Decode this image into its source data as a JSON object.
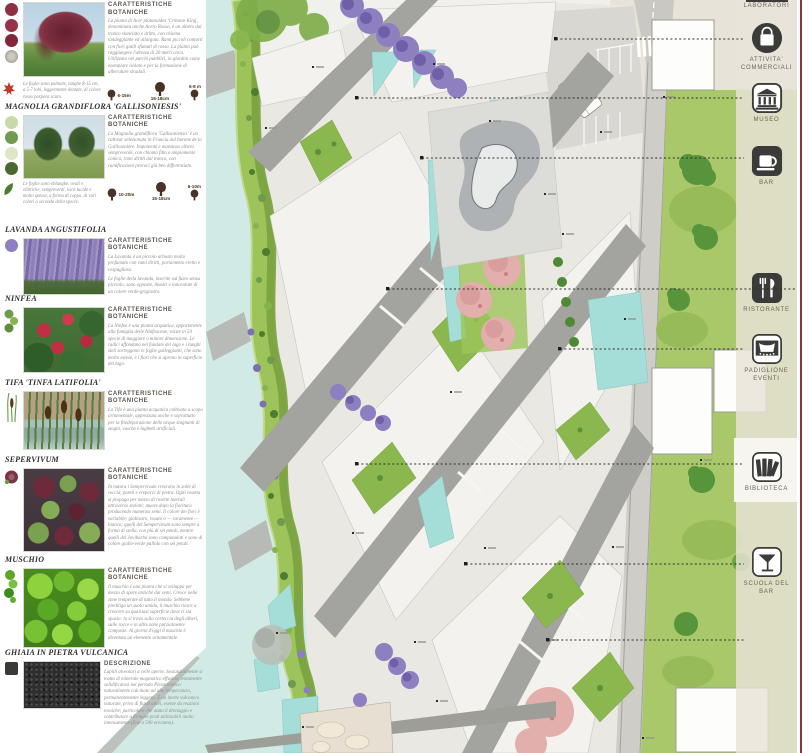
{
  "palette": {
    "river": "#d2eae6",
    "pool": "#a5ded9",
    "lawn": "#a9c869",
    "bank_green": "#9cc45a",
    "plaza": "#e9e8e3",
    "path_gray": "#a3a39f",
    "pink_trees": "#e2afac",
    "lavender": "#8d7fc0",
    "strip_beige": "#e9e4da",
    "border_red": "#8e3438",
    "icon_dark": "#3b3b39"
  },
  "left_panel": {
    "sections": [
      {
        "id": "acer",
        "heading": "CARATTERISTICHE BOTANICHE",
        "body": "La pianta di Acer platanoides 'Crimson King', denominata anche Acero Rosso, è un albero dal tronco slanciato e dritto, con chioma tondeggiante ed allargata. Rami piccoli contorti con fiori gialli sfumati di rosso. La pianta può raggiungere l'altezza di 20 metri circa. Utilizzato nei parchi pubblici, in giardini come esemplare isolato e per la formazione di alberature stradali.",
        "caption": "Le foglie sono palmate, lunghe 8-15 cm, a 5-7 lobi, leggermente dentate, di colore rosso porpora scuro.",
        "sizes": [
          "6-15m",
          "15-18cm",
          "6-8 m"
        ]
      },
      {
        "id": "magnolia",
        "title": "MAGNOLIA GRANDIFLORA 'GALLISONIESIS'",
        "heading": "CARATTERISTICHE BOTANICHE",
        "body": "La Magnolia grandiflora 'Gallisoniensis' è un cultivar selezionata in Francia dal barone de la Gallissonière. Imponente e maestoso albero sempreverde, con chioma fitta e ampiamente conica, rami diritti dal tronco, con ramificazioni precoci già ben differenziate.",
        "caption": "Le foglie sono oblunghe, ovali e ellittiche, sempreverdi, lisce lucide e molto spesse, a forma di coppa, di vari colori a seconda della specie.",
        "sizes": [
          "10-20m",
          "15-18cm",
          "6-10m"
        ]
      },
      {
        "id": "lavanda",
        "title": "LAVANDA ANGUSTIFOLIA",
        "heading": "CARATTERISTICHE BOTANICHE",
        "body": "La Lavanda è un piccolo arbusto molto profumato con rami diritti, portamento eretto e cespuglioso.",
        "body2": "Le foglie della lavanda, inserite sul fusto senza picciolo, sono opposte, lineari e lanceolate di un colore verde-grigiastro."
      },
      {
        "id": "ninfea",
        "title": "NINFEA",
        "heading": "CARATTERISTICHE BOTANICHE",
        "body": "La Ninfea è una pianta acquatica, appartenente alla famiglia delle Ninfeaceae; esiste in 50 specie di maggiore o minore dimensione. Le radici affondano nel fondale del lago e i lunghi steli sorreggono le foglie galleggianti, che sono molto estese, e i fiori che si aprono in superficie del lago."
      },
      {
        "id": "tifa",
        "title": "TIFA 'TINFA LATIFOLIA'",
        "heading": "CARATTERISTICHE BOTANICHE",
        "body": "La Tifa è una pianta acquatica coltivata a scopo ornamentale, apprezzata anche e soprattutto per la fitodepurazione delle acque stagnanti di stagni, vasche e laghetti artificiali."
      },
      {
        "id": "sempervivum",
        "title": "SEPERVIVUM",
        "heading": "CARATTERISTICHE BOTANICHE",
        "body": "In natura i Sempervivum crescono in zolle di roccia, pareti e crepacci di pietra. Ogni rosetta si propaga per mezzo di rosette laterali attraverso stoloni; muore dopo la fioritura producendo numerosi semi. Il colore dei fiori è variabile: giallastro, rosato o — raramente — bianco; quelli del Sempervivum sono sempre a forma di stella, con più di sei petali, mentre quelli del Jovibarba sono campanulati e sono di colore giallo-verde pallido con sei petali."
      },
      {
        "id": "muschio",
        "title": "MUSCHIO",
        "heading": "CARATTERISTICHE BOTANICHE",
        "body": "Il muschio è una pianta che si sviluppa per mezzo di spore anziché dai semi. Cresce nelle zone temperate di tutto il mondo. Sebbene prediliga un suolo umido, il muschio riesce a crescere su qualsiasi superficie dove ci sia spazio: lo si trova sulla corteccia degli alberi, sulle rocce e in altre zone parzialmente composte. Al giorno d'oggi il muschio è diventato un elemento ornamentale."
      },
      {
        "id": "ghiaia",
        "title": "GHIAIA IN PIETRA VULCANICA",
        "heading": "DESCRIZIONE",
        "body": "Lapilli alveolari a celle aperte. Sostanzialmente si tratta di minerale magmatico effusivo, lentamente solidificatosi nel periodo Pleistocenico: naturalmente calcinato ad alta temperatura, permanentemente leggero. È un inerte vulcanico naturale, privo di flussi attivi, esente da reazioni tossiche; particolare che aiuta il drenaggio e contribuisce a formare prati utilizzabili molto intensamente (fino a 500 ore/anno)."
      }
    ]
  },
  "facility_strip": {
    "top_cut_label": "LABORATORI",
    "items": [
      {
        "label": "ATTIVITA' COMMERCIALI",
        "icon": "shopping-bag"
      },
      {
        "label": "MUSEO",
        "icon": "museum"
      },
      {
        "label": "BAR",
        "icon": "coffee-cup"
      },
      {
        "label": "RISTORANTE",
        "icon": "fork-knife"
      },
      {
        "label": "PADIGLIONE EVENTI",
        "icon": "stage-curtain"
      },
      {
        "label": "BIBLIOTECA",
        "icon": "books"
      },
      {
        "label": "SCUOLA DEL BAR",
        "icon": "cocktail-glass"
      }
    ]
  }
}
